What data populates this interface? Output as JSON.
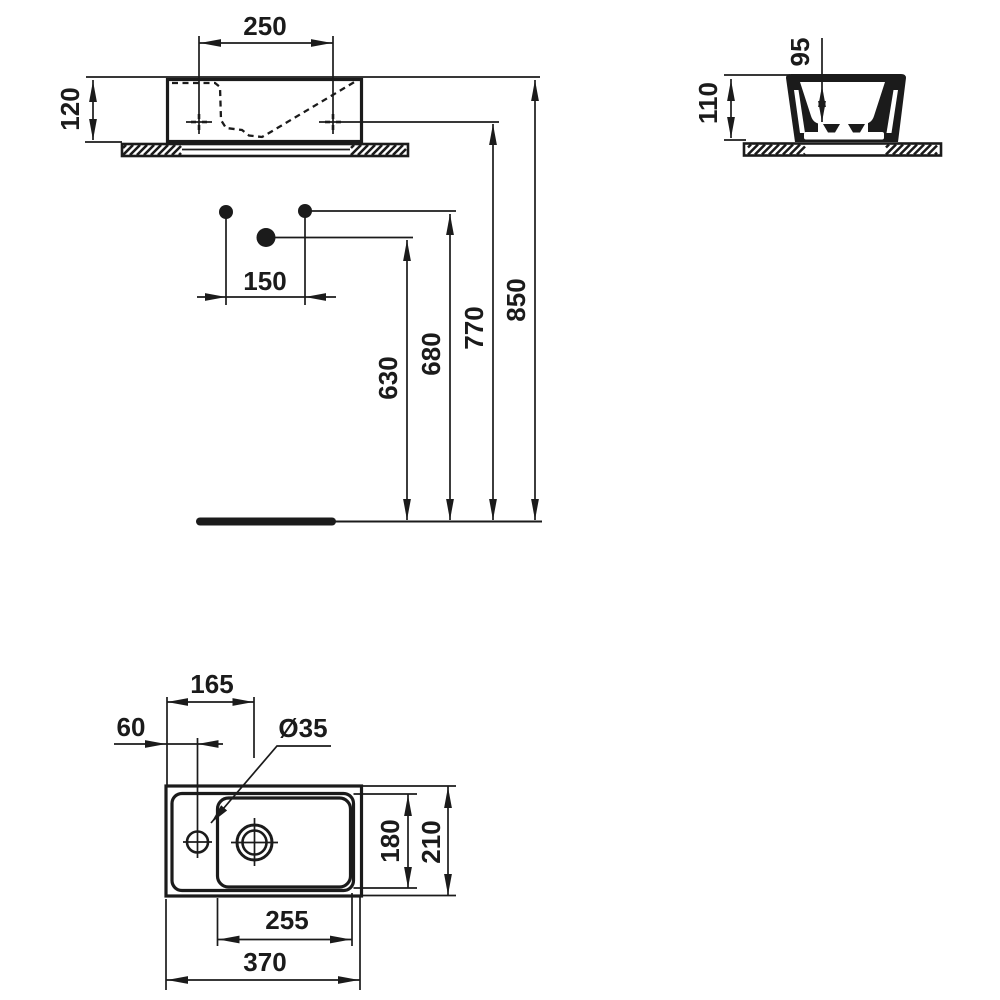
{
  "colors": {
    "ink": "#1b1b1b",
    "background": "#ffffff"
  },
  "views": {
    "front": {
      "dims": {
        "dim_250": "250",
        "dim_120": "120",
        "dim_150": "150",
        "dim_630": "630",
        "dim_680": "680",
        "dim_770": "770",
        "dim_850": "850"
      }
    },
    "side": {
      "dims": {
        "dim_95": "95",
        "dim_110": "110"
      }
    },
    "plan": {
      "dims": {
        "dim_165": "165",
        "dim_60": "60",
        "dim_35": "Ø35",
        "dim_180": "180",
        "dim_210": "210",
        "dim_255": "255",
        "dim_370": "370"
      }
    }
  }
}
